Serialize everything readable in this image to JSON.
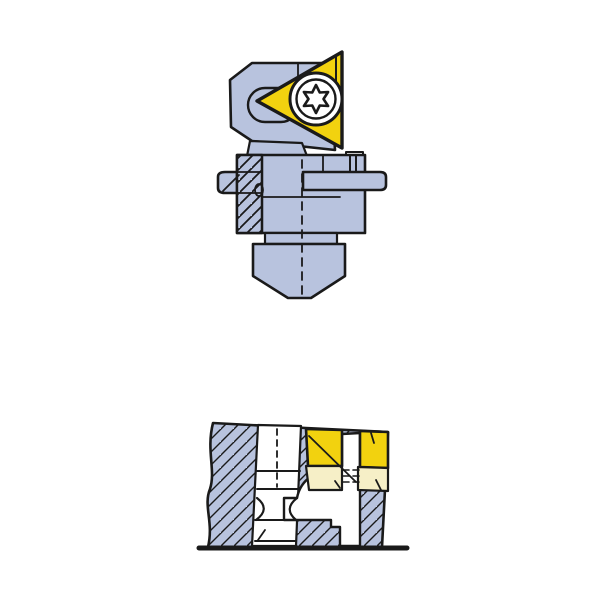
{
  "canvas": {
    "width": 600,
    "height": 600,
    "background": "#ffffff"
  },
  "colors": {
    "outline": "#1a1a1a",
    "body": "#b8c3de",
    "insert_yellow": "#f2d20f",
    "shim_cream": "#f6efc7",
    "white": "#ffffff"
  },
  "figures": {
    "assembly": {
      "label": "cartridge-assembly-side-view",
      "parts": [
        "insert-head",
        "insert-pocket-slot",
        "triangular-insert",
        "torx-clamp-screw",
        "cylindrical-clamp-body",
        "locating-pin",
        "adjusting-bar",
        "step-rings",
        "mounting-shank-cone",
        "center-line"
      ]
    },
    "section": {
      "label": "installed-cross-section-view",
      "parts": [
        "housing-block-hatched",
        "clamp-screw-bore",
        "screw-waist",
        "triangular-insert-section",
        "insert-shim",
        "coolant-channel-elbow",
        "thread-marks",
        "base-line"
      ]
    }
  }
}
